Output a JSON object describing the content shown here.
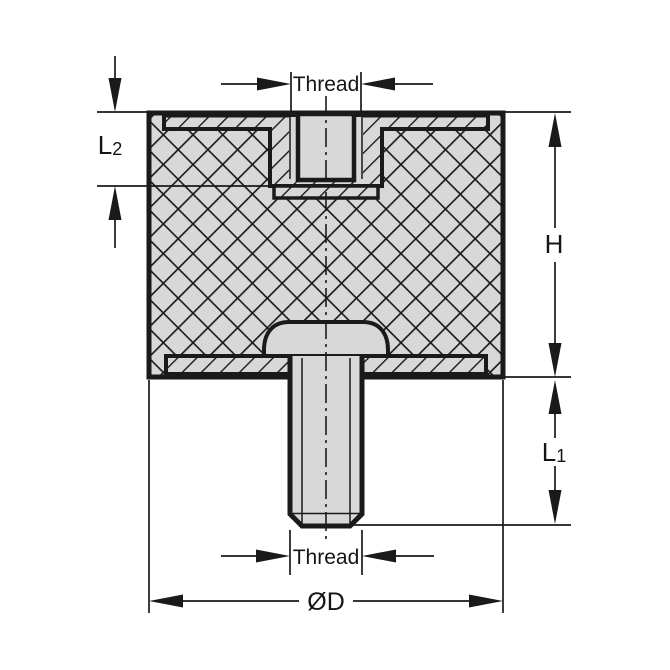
{
  "drawing": {
    "labels": {
      "thread_top": "Thread",
      "thread_bottom": "Thread",
      "height": "H",
      "l1_main": "L",
      "l1_sub": "1",
      "l2_main": "L",
      "l2_sub": "2",
      "diameter": "ØD"
    },
    "colors": {
      "background": "#ffffff",
      "section_fill": "#d8d8d8",
      "line": "#1a1a1a",
      "text": "#151515"
    }
  }
}
